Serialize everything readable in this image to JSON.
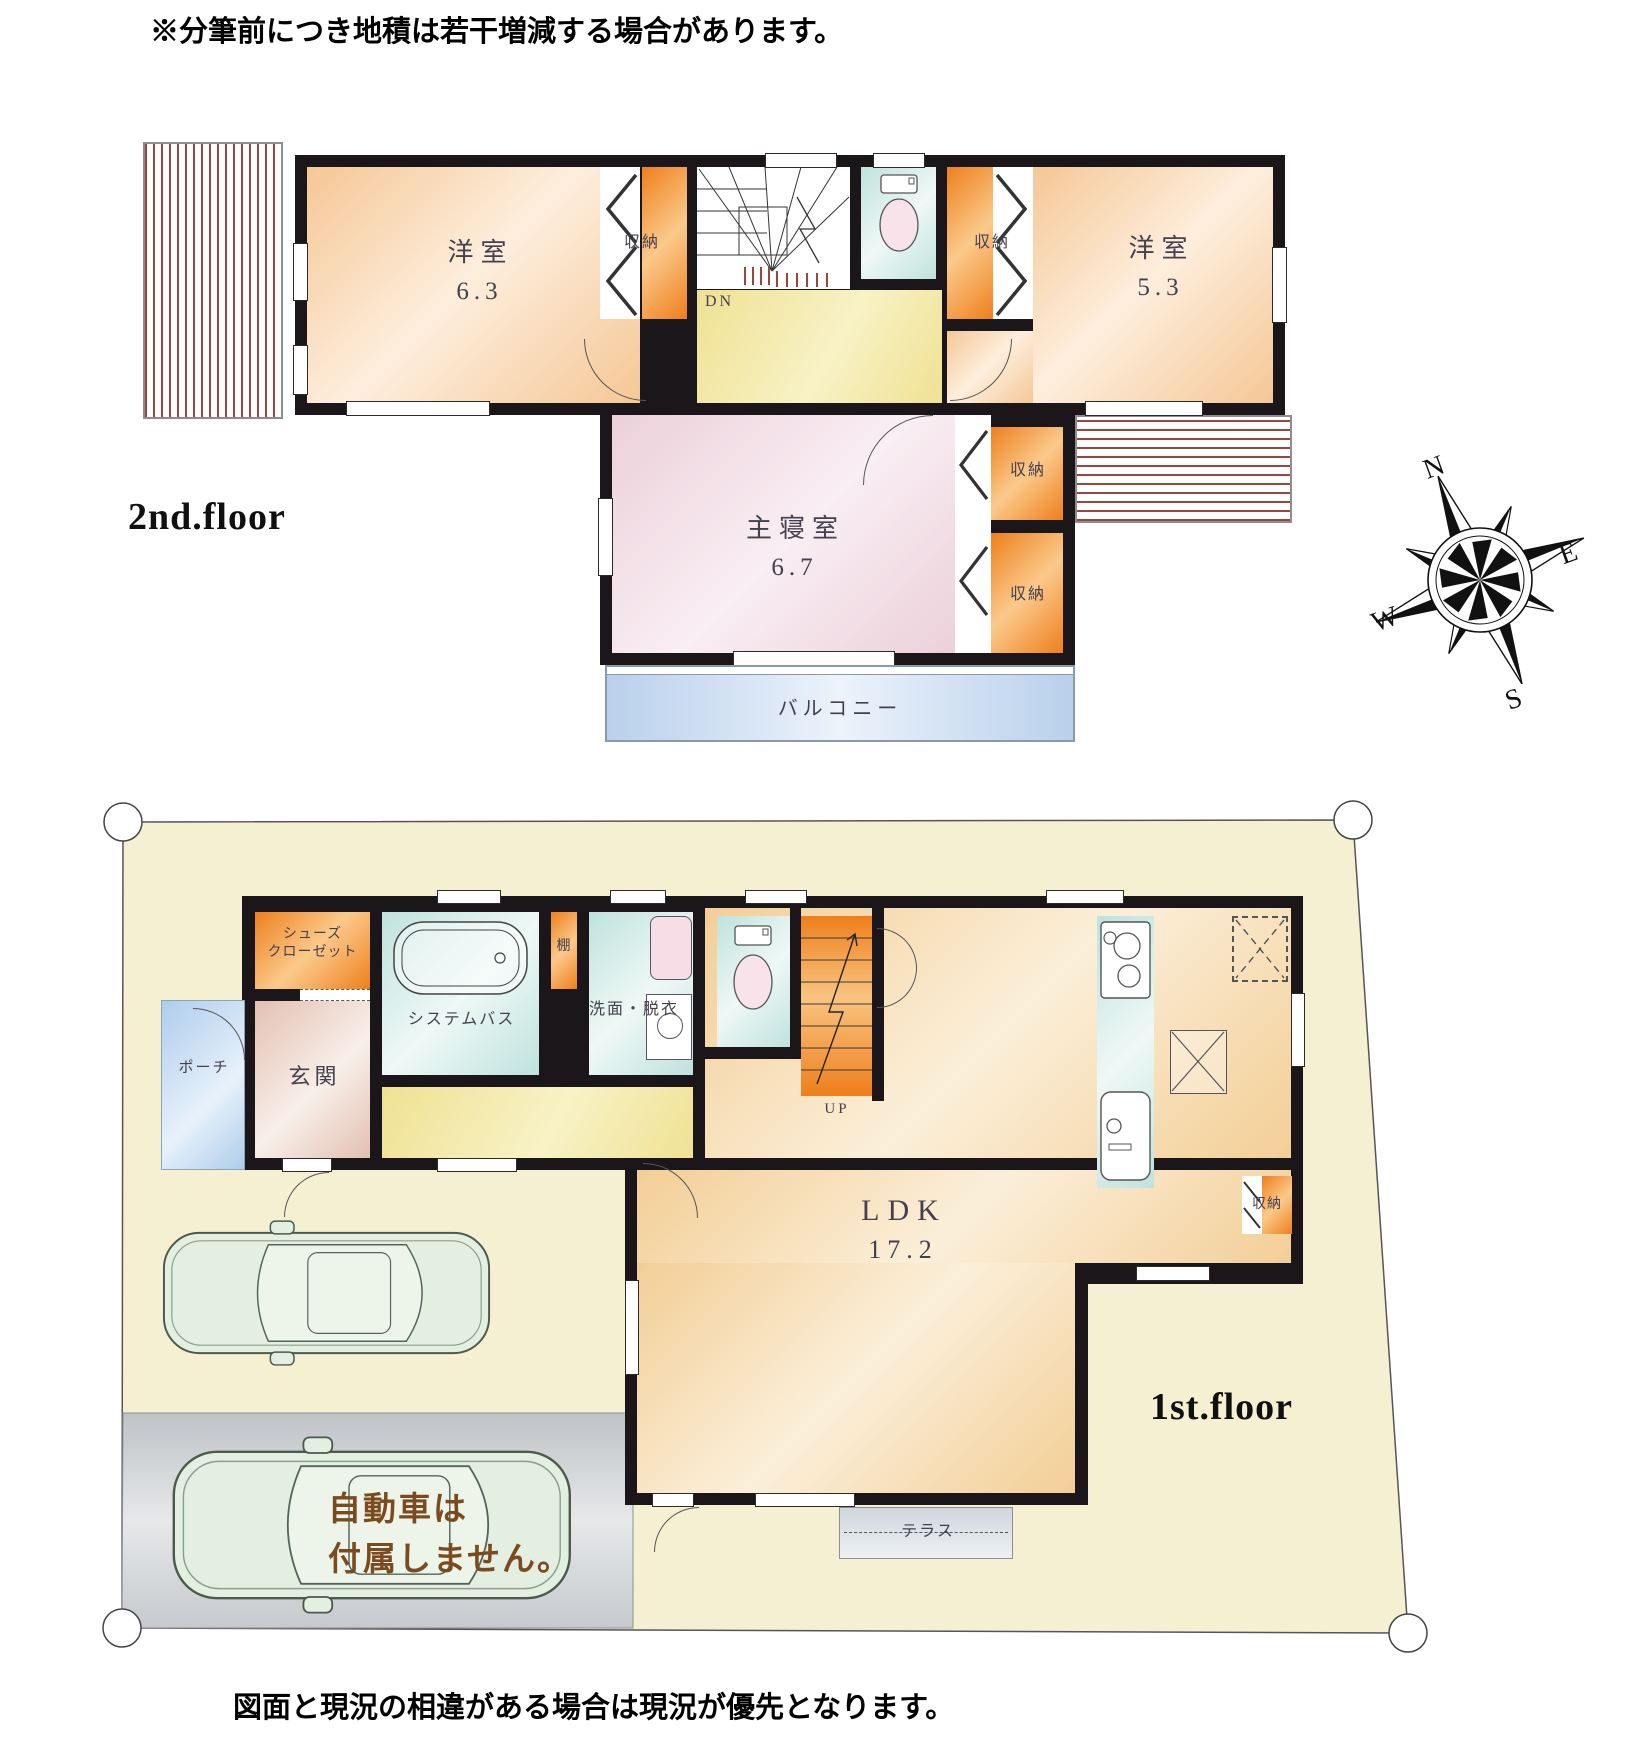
{
  "notes": {
    "top": "※分筆前につき地積は若干増減する場合があります。",
    "bottom": "図面と現況の相違がある場合は現況が優先となります。",
    "car_line1": "自動車は",
    "car_line2": "付属しません。"
  },
  "compass": {
    "n": "N",
    "e": "E",
    "w": "W",
    "s": "S"
  },
  "floor2": {
    "label": "2nd.floor",
    "room_west": {
      "name": "洋室",
      "area": "6.3"
    },
    "room_east": {
      "name": "洋室",
      "area": "5.3"
    },
    "master": {
      "name": "主寝室",
      "area": "6.7"
    },
    "closet": "収納",
    "balcony": "バルコニー",
    "stairs_down": "DN"
  },
  "floor1": {
    "label": "1st.floor",
    "shoes_closet_line1": "シューズ",
    "shoes_closet_line2": "クローゼット",
    "entrance": "玄関",
    "porch": "ポーチ",
    "bath": "システムバス",
    "shelf": "棚",
    "washroom": "洗面・脱衣",
    "stairs_up": "UP",
    "ldk": {
      "name": "LDK",
      "area": "17.2"
    },
    "closet": "収納",
    "terrace": "テラス"
  },
  "colors": {
    "wall": "#1b161a",
    "site": "#f6f0d3",
    "closet_orange": "#ee7f1c",
    "balcony_blue": "#b9d0eb",
    "parking_gray": "#c3c6ca",
    "car_note_brown": "#7b4a1f"
  }
}
